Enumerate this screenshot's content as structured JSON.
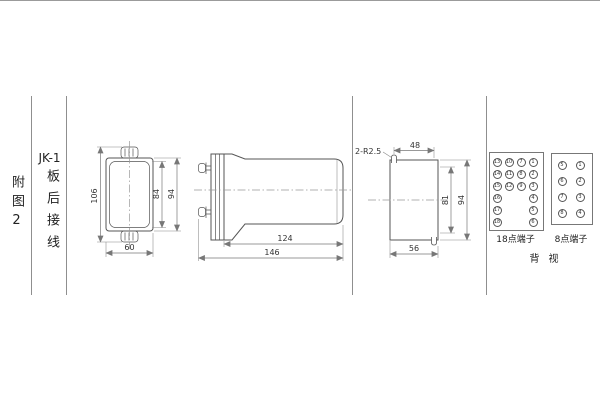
{
  "row_header": {
    "figure_label": "附图2",
    "model": "JK-1",
    "wiring_label": "板后接线"
  },
  "front_view": {
    "dim_total_height": "106",
    "dim_inner_height": "84",
    "dim_case_height": "94",
    "dim_width": "60"
  },
  "side_view": {
    "dim_body_depth": "124",
    "dim_total_depth": "146"
  },
  "cutout_view": {
    "slot_note": "2-R2.5",
    "dim_slot_span": "48",
    "dim_inner_height": "81",
    "dim_total_height": "94",
    "dim_width": "56"
  },
  "terminals": {
    "t18": {
      "label": "18点端子",
      "cells": [
        [
          "13",
          "10",
          "7",
          "1"
        ],
        [
          "14",
          "11",
          "8",
          "2"
        ],
        [
          "15",
          "12",
          "9",
          "3"
        ],
        [
          "16",
          "",
          "",
          "4"
        ],
        [
          "17",
          "",
          "",
          "5"
        ],
        [
          "18",
          "",
          "",
          "6"
        ]
      ]
    },
    "t8": {
      "label": "8点端子",
      "cells": [
        [
          "5",
          "1"
        ],
        [
          "6",
          "2"
        ],
        [
          "7",
          "3"
        ],
        [
          "8",
          "4"
        ]
      ]
    },
    "view_label": "背视"
  }
}
